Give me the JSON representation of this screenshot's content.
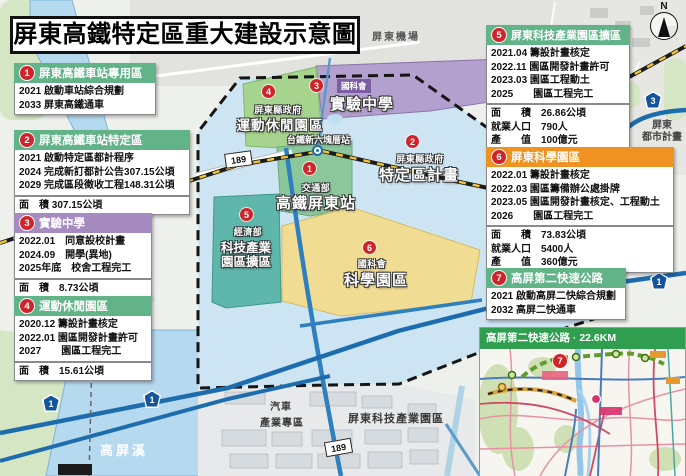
{
  "title": "屏東高鐵特定區重大建設示意圖",
  "compass": {
    "label": "N"
  },
  "boxes": [
    {
      "num": "1",
      "title": "屏東高鐵車站專用區",
      "rows": [
        "2021 啟動車站綜合規劃",
        "2033 屏東高鐵通車"
      ]
    },
    {
      "num": "2",
      "title": "屏東高鐵車站特定區",
      "rows": [
        "2021 啟動特定區都計程序",
        "2024 完成新訂都計公告307.15公頃",
        "2029 完成區段徵收工程148.31公頃"
      ],
      "stats": [
        "面　積 307.15公頃"
      ]
    },
    {
      "num": "3",
      "title": "實驗中學",
      "rows": [
        "2022.01　同意設校計畫",
        "2024.09　開學(異地)",
        "2025年底　校舍工程完工"
      ],
      "stats": [
        "面　積　8.73公頃"
      ]
    },
    {
      "num": "4",
      "title": "運動休閒園區",
      "rows": [
        "2020.12 籌設計畫核定",
        "2022.01 園區開發計畫許可",
        "2027　　園區工程完工"
      ],
      "stats": [
        "面　積　15.61公頃"
      ]
    },
    {
      "num": "5",
      "title": "屏東科技產業園區擴區",
      "rows": [
        "2021.04 籌設計畫核定",
        "2022.11 園區開發計畫許可",
        "2023.03 園區工程動土",
        "2025　　園區工程完工"
      ],
      "stats": [
        "面　　積　26.86公頃",
        "就業人口　790人",
        "產　　值　100億元"
      ]
    },
    {
      "num": "6",
      "title": "屏東科學園區",
      "rows": [
        "2022.01 籌設計畫核定",
        "2022.03 園區籌備辦公處掛牌",
        "2023.05 園區開發計畫核定、工程動土",
        "2026　　園區工程完工"
      ],
      "stats": [
        "面　　積　73.83公頃",
        "就業人口　5400人",
        "產　　值　360億元"
      ]
    },
    {
      "num": "7",
      "title": "高屏第二快速公路",
      "rows": [
        "2021 啟動高屏二快綜合規劃",
        "2032 高屏二快通車"
      ]
    }
  ],
  "map": {
    "airport": "屏東機場",
    "city_plan_l1": "屏東",
    "city_plan_l2": "都市計畫",
    "river": "高屏溪",
    "station_stop": "台鐵新六塊厝站",
    "industrial": "屏東科技產業園區",
    "auto_zone_l1": "汽車",
    "auto_zone_l2": "產業專區",
    "areas": [
      {
        "num": "1",
        "org": "交通部",
        "name": "高鐵屏東站"
      },
      {
        "num": "2",
        "org": "屏東縣政府",
        "name": "特定區計畫"
      },
      {
        "num": "3",
        "org": "國科會",
        "name": "實驗中學"
      },
      {
        "num": "4",
        "org": "屏東縣政府",
        "name": "運動休閒園區"
      },
      {
        "num": "5",
        "org": "經濟部",
        "name_l1": "科技產業",
        "name_l2": "園區擴區"
      },
      {
        "num": "6",
        "org": "國科會",
        "name": "科學園區"
      }
    ],
    "shields": {
      "freeway1": "1",
      "freeway3": "3",
      "county189": "189"
    }
  },
  "inset": {
    "num": "7",
    "title": "高屏第二快速公路 · 22.6KM"
  },
  "colors": {
    "header_green": "#62b488",
    "header_purple": "#a58bc0",
    "header_orange": "#ef9222",
    "badge_red": "#d1232a",
    "district_blue": "#cde4f2",
    "science_yellow": "#f0dc92",
    "tech_teal": "#5fb7ac",
    "sports_green": "#a6d38e",
    "school_purple": "#b4a0cf"
  }
}
